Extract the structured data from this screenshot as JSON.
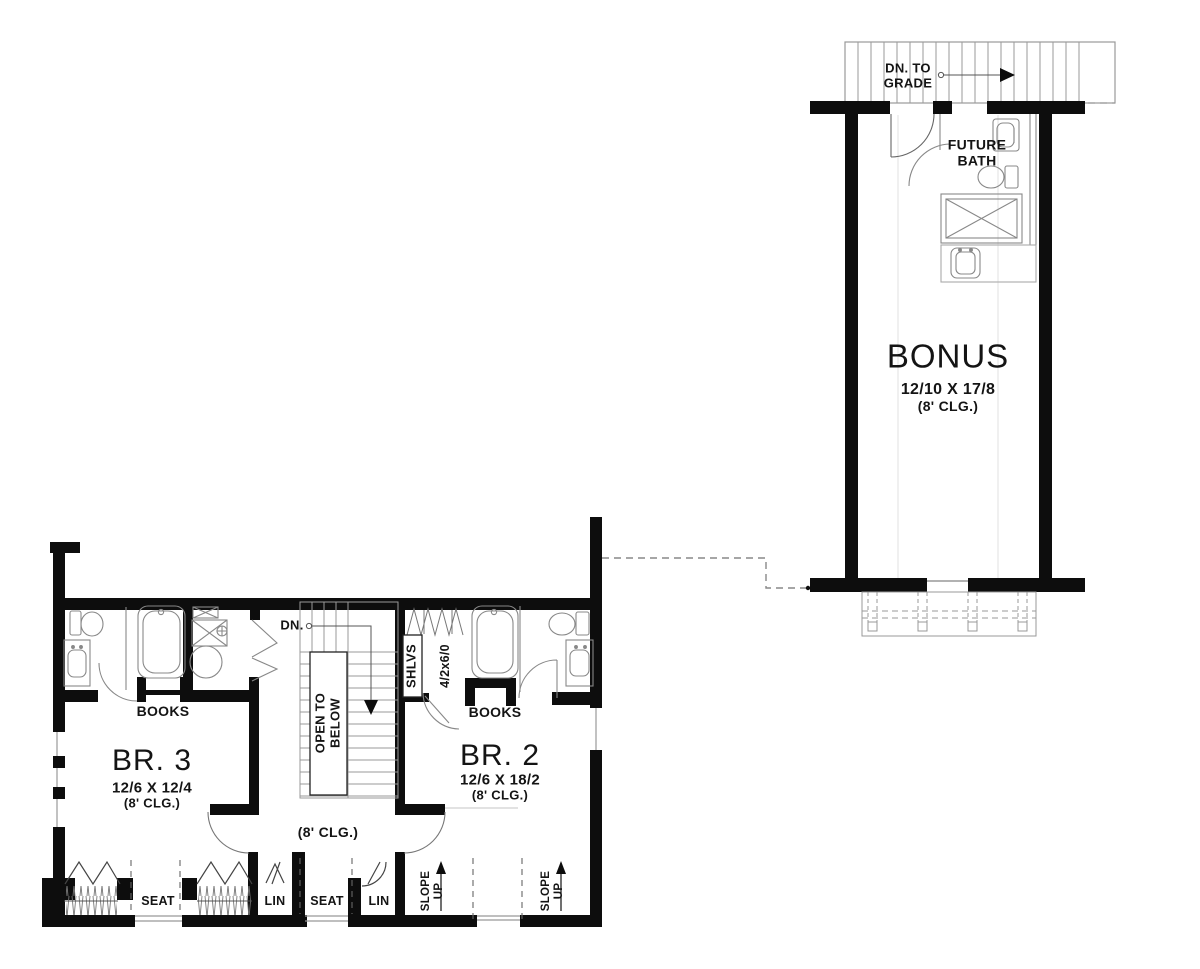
{
  "colors": {
    "ink": "#0d0d0d",
    "thin_line": "#8a8a8a",
    "faint_line": "#d9d9d9"
  },
  "bonus_suite": {
    "stair_note": {
      "line1": "DN. TO",
      "line2": "GRADE"
    },
    "bath": {
      "line1": "FUTURE",
      "line2": "BATH"
    },
    "room": {
      "name": "BONUS",
      "dimensions": "12/10 X 17/8",
      "ceiling": "(8' CLG.)"
    }
  },
  "main_floor": {
    "bedroom3": {
      "name": "BR. 3",
      "dimensions": "12/6 X 12/4",
      "ceiling": "(8' CLG.)"
    },
    "bedroom2": {
      "name": "BR. 2",
      "dimensions": "12/6 X 18/2",
      "ceiling": "(8' CLG.)"
    },
    "books_left": "BOOKS",
    "books_right": "BOOKS",
    "stair": {
      "down": "DN.",
      "open_below_line1": "OPEN TO",
      "open_below_line2": "BELOW"
    },
    "closet": {
      "shelves": "SHLVS",
      "window_size": "4/2x6/0"
    },
    "hall_ceiling": "(8' CLG.)",
    "seat_left": "SEAT",
    "lin_left": "LIN",
    "seat_right": "SEAT",
    "lin_right": "LIN",
    "slope_left": {
      "line1": "SLOPE",
      "line2": "UP"
    },
    "slope_right": {
      "line1": "SLOPE",
      "line2": "UP"
    }
  }
}
